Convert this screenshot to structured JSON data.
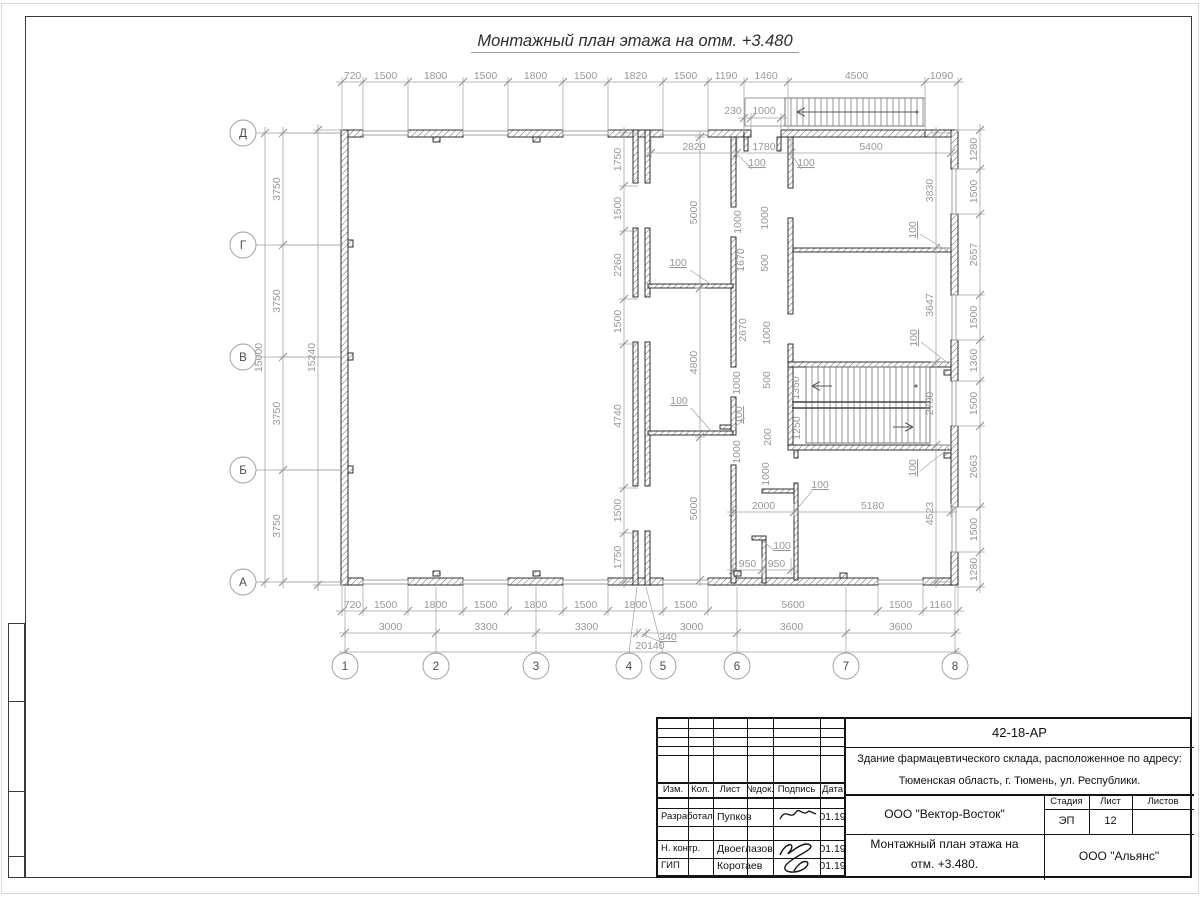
{
  "title": "Монтажный план этажа на отм. +3.480",
  "plan": {
    "colors": {
      "wall_stroke": "#1c1c1c",
      "dim": "#a3a3a3",
      "dim_text": "#989898",
      "bubble_text": "#4a4a4a",
      "stair": "#6b6b6b"
    },
    "walls": [
      [
        341,
        130,
        22,
        7
      ],
      [
        408,
        130,
        55,
        7
      ],
      [
        508,
        130,
        55,
        7
      ],
      [
        608,
        130,
        55,
        7
      ],
      [
        708,
        130,
        36,
        7
      ],
      [
        744,
        130,
        7,
        7
      ],
      [
        781,
        130,
        144,
        7
      ],
      [
        925,
        130,
        33,
        7
      ],
      [
        744,
        137,
        4,
        14
      ],
      [
        777,
        137,
        4,
        14
      ],
      [
        341,
        578,
        22,
        7
      ],
      [
        408,
        578,
        55,
        7
      ],
      [
        508,
        578,
        55,
        7
      ],
      [
        608,
        578,
        55,
        7
      ],
      [
        708,
        578,
        170,
        7
      ],
      [
        923,
        578,
        35,
        7
      ],
      [
        341,
        130,
        7,
        455
      ],
      [
        951,
        130,
        7,
        39
      ],
      [
        951,
        214,
        7,
        81
      ],
      [
        951,
        340,
        7,
        41
      ],
      [
        951,
        426,
        7,
        81
      ],
      [
        951,
        552,
        7,
        33
      ],
      [
        633,
        130,
        5,
        53
      ],
      [
        633,
        228,
        5,
        69
      ],
      [
        633,
        342,
        5,
        144
      ],
      [
        633,
        531,
        5,
        54
      ],
      [
        645,
        130,
        5,
        53
      ],
      [
        645,
        228,
        5,
        69
      ],
      [
        645,
        342,
        5,
        144
      ],
      [
        645,
        531,
        5,
        54
      ],
      [
        731,
        137,
        5,
        70
      ],
      [
        731,
        237,
        5,
        130
      ],
      [
        731,
        397,
        5,
        38
      ],
      [
        731,
        465,
        5,
        118
      ],
      [
        788,
        137,
        5,
        51
      ],
      [
        788,
        218,
        5,
        96
      ],
      [
        788,
        344,
        5,
        18
      ],
      [
        788,
        362,
        163,
        5
      ],
      [
        788,
        367,
        5,
        78
      ],
      [
        788,
        445,
        163,
        5
      ],
      [
        794,
        450,
        4,
        8
      ],
      [
        794,
        483,
        4,
        97
      ],
      [
        793,
        248,
        158,
        4
      ],
      [
        648,
        284,
        85,
        4
      ],
      [
        648,
        431,
        85,
        4
      ],
      [
        762,
        489,
        32,
        4
      ],
      [
        762,
        539,
        4,
        44
      ],
      [
        752,
        536,
        14,
        4
      ],
      [
        720,
        425,
        11,
        4
      ],
      [
        348,
        240,
        5,
        7
      ],
      [
        348,
        353,
        5,
        7
      ],
      [
        348,
        466,
        5,
        7
      ],
      [
        433,
        137,
        7,
        5
      ],
      [
        533,
        137,
        7,
        5
      ],
      [
        433,
        571,
        7,
        5
      ],
      [
        533,
        571,
        7,
        5
      ],
      [
        734,
        571,
        7,
        5
      ],
      [
        840,
        573,
        7,
        5
      ],
      [
        944,
        370,
        7,
        5
      ],
      [
        944,
        453,
        7,
        5
      ]
    ],
    "windows": [
      [
        363,
        131,
        45,
        4
      ],
      [
        463,
        131,
        45,
        4
      ],
      [
        563,
        131,
        45,
        4
      ],
      [
        663,
        131,
        45,
        4
      ],
      [
        363,
        580,
        45,
        4
      ],
      [
        463,
        580,
        45,
        4
      ],
      [
        563,
        580,
        45,
        4
      ],
      [
        663,
        580,
        45,
        4
      ],
      [
        878,
        580,
        45,
        4
      ],
      [
        952,
        169,
        4,
        45
      ],
      [
        952,
        295,
        4,
        45
      ],
      [
        952,
        381,
        4,
        45
      ],
      [
        952,
        507,
        4,
        45
      ]
    ],
    "lines": [
      [
        745,
        98,
        745,
        126
      ],
      [
        745,
        98,
        785,
        98
      ],
      [
        745,
        126,
        785,
        126
      ]
    ],
    "stairs": [
      {
        "x": 785,
        "y": 98,
        "w": 140,
        "h": 28,
        "step": 6,
        "rails": []
      },
      {
        "x": 806,
        "y": 367,
        "w": 124,
        "h": 76,
        "step": 6,
        "rails": [
          402,
          408
        ]
      }
    ],
    "arrows": [
      {
        "x1": 916,
        "y1": 112,
        "x2": 797,
        "y2": 112
      },
      {
        "x1": 832,
        "y1": 386,
        "x2": 812,
        "y2": 386
      },
      {
        "x1": 893,
        "y1": 427,
        "x2": 913,
        "y2": 427
      }
    ],
    "dots": [
      [
        916,
        386
      ],
      [
        917,
        112
      ]
    ],
    "dims": [
      {
        "d": "h",
        "c": 82,
        "e": [
          -5,
          50
        ],
        "pts": [
          342,
          363,
          408,
          463,
          508,
          563,
          608,
          663,
          708,
          744,
          788,
          925,
          958
        ],
        "labels": [
          "720",
          "1500",
          "1800",
          "1500",
          "1800",
          "1500",
          "1820",
          "1500",
          "1190",
          "1460",
          "4500",
          "1090"
        ]
      },
      {
        "d": "h",
        "c": 118,
        "e": [
          -5,
          12
        ],
        "pts": [
          744,
          751,
          781
        ],
        "labels": [
          "",
          ""
        ]
      },
      {
        "d": "h",
        "c": 153,
        "e": [
          -16,
          5
        ],
        "pts": [
          651,
          737,
          791,
          951
        ],
        "labels": [
          "2820",
          "1780",
          "5400"
        ]
      },
      {
        "d": "h",
        "c": 611,
        "e": [
          -26,
          5
        ],
        "pts": [
          342,
          363,
          408,
          463,
          508,
          563,
          608,
          663,
          708,
          878,
          923,
          958
        ],
        "labels": [
          "720",
          "1500",
          "1800",
          "1500",
          "1800",
          "1500",
          "1800",
          "1500",
          "5600",
          "1500",
          "1160"
        ]
      },
      {
        "d": "h",
        "c": 633,
        "e": [
          -5,
          5
        ],
        "pts": [
          345,
          436,
          536,
          637,
          646,
          737,
          846,
          955
        ],
        "labels": [
          "3000",
          "3300",
          "3300",
          "",
          "3000",
          "3600",
          "3600"
        ]
      },
      {
        "d": "h",
        "c": 652,
        "e": [
          -5,
          5
        ],
        "pts": [
          345,
          955
        ],
        "labels": [
          "20140"
        ]
      },
      {
        "d": "h",
        "c": 512,
        "e": [
          -8,
          5
        ],
        "pts": [
          733,
          794,
          951
        ],
        "labels": [
          "2000",
          "5180"
        ]
      },
      {
        "d": "h",
        "c": 570,
        "e": [
          -12,
          5
        ],
        "pts": [
          733,
          762,
          791
        ],
        "labels": [
          "950",
          "950"
        ]
      },
      {
        "d": "v",
        "c": 283,
        "e": [
          -5,
          60
        ],
        "pts": [
          133,
          245,
          357,
          470,
          582
        ],
        "labels": [
          "3750",
          "3750",
          "3750",
          "3750"
        ]
      },
      {
        "d": "v",
        "c": 265,
        "e": [
          -5,
          5
        ],
        "pts": [
          133,
          582
        ],
        "labels": [
          "15000"
        ]
      },
      {
        "d": "v",
        "c": 318,
        "e": [
          -5,
          25
        ],
        "pts": [
          130,
          585
        ],
        "labels": [
          "15240"
        ]
      },
      {
        "d": "v",
        "c": 624,
        "e": [
          -5,
          14
        ],
        "pts": [
          133,
          186,
          231,
          299,
          344,
          488,
          533,
          582
        ],
        "labels": [
          "1750",
          "1500",
          "2260",
          "1500",
          "4740",
          "1500",
          "1750"
        ]
      },
      {
        "d": "v",
        "c": 700,
        "e": [
          -5,
          5
        ],
        "pts": [
          137,
          288,
          437,
          580
        ],
        "labels": [
          "5000",
          "4800",
          "5000"
        ]
      },
      {
        "d": "v",
        "c": 936,
        "e": [
          -5,
          17
        ],
        "pts": [
          133,
          248,
          362,
          445,
          582
        ],
        "labels": [
          "3830",
          "3647",
          "2700",
          "4523"
        ]
      },
      {
        "d": "v",
        "c": 980,
        "e": [
          -25,
          5
        ],
        "pts": [
          130,
          169,
          214,
          295,
          340,
          381,
          426,
          507,
          552,
          587
        ],
        "labels": [
          "1280",
          "1500",
          "2657",
          "1500",
          "1360",
          "1500",
          "2663",
          "1500",
          "1280"
        ]
      }
    ],
    "free_labels": [
      {
        "t": "230",
        "x": 733,
        "y": 114
      },
      {
        "t": "1000",
        "x": 764,
        "y": 114
      },
      {
        "t": "100",
        "x": 757,
        "y": 166,
        "u": 1
      },
      {
        "t": "100",
        "x": 806,
        "y": 166,
        "u": 1
      },
      {
        "t": "100",
        "x": 678,
        "y": 266,
        "u": 1
      },
      {
        "t": "100",
        "x": 679,
        "y": 404,
        "u": 1
      },
      {
        "t": "1000",
        "x": 741,
        "y": 222,
        "r": 1
      },
      {
        "t": "1000",
        "x": 768,
        "y": 218,
        "r": 1
      },
      {
        "t": "1670",
        "x": 744,
        "y": 260,
        "r": 1
      },
      {
        "t": "500",
        "x": 768,
        "y": 263,
        "r": 1
      },
      {
        "t": "2670",
        "x": 746,
        "y": 330,
        "r": 1
      },
      {
        "t": "1000",
        "x": 770,
        "y": 333,
        "r": 1
      },
      {
        "t": "500",
        "x": 770,
        "y": 380,
        "r": 1
      },
      {
        "t": "1000",
        "x": 740,
        "y": 383,
        "r": 1
      },
      {
        "t": "100",
        "x": 742,
        "y": 415,
        "r": 1,
        "u": 1
      },
      {
        "t": "1350",
        "x": 799,
        "y": 388,
        "r": 1
      },
      {
        "t": "1250",
        "x": 800,
        "y": 428,
        "r": 1
      },
      {
        "t": "200",
        "x": 771,
        "y": 437,
        "r": 1
      },
      {
        "t": "1000",
        "x": 740,
        "y": 452,
        "r": 1
      },
      {
        "t": "1000",
        "x": 769,
        "y": 474,
        "r": 1
      },
      {
        "t": "100",
        "x": 820,
        "y": 488,
        "u": 1
      },
      {
        "t": "100",
        "x": 782,
        "y": 549,
        "u": 1
      },
      {
        "t": "100",
        "x": 916,
        "y": 230,
        "r": 1,
        "u": 1
      },
      {
        "t": "100",
        "x": 917,
        "y": 338,
        "r": 1,
        "u": 1
      },
      {
        "t": "100",
        "x": 916,
        "y": 468,
        "r": 1,
        "u": 1
      },
      {
        "t": "340",
        "x": 668,
        "y": 640,
        "u": 1
      }
    ],
    "leaders": [
      [
        752,
        169,
        738,
        155
      ],
      [
        801,
        169,
        792,
        155
      ],
      [
        690,
        270,
        712,
        285
      ],
      [
        691,
        408,
        712,
        432
      ],
      [
        812,
        491,
        796,
        510
      ],
      [
        775,
        551,
        763,
        541
      ],
      [
        745,
        418,
        734,
        428
      ],
      [
        920,
        234,
        949,
        252
      ],
      [
        921,
        342,
        949,
        364
      ],
      [
        920,
        471,
        949,
        448
      ],
      [
        663,
        643,
        642,
        634
      ]
    ],
    "axes_bottom": {
      "cy": 666,
      "r": 13,
      "wall_y": 587,
      "items": [
        {
          "n": "1",
          "x": 345,
          "lx": 345
        },
        {
          "n": "2",
          "x": 436,
          "lx": 436
        },
        {
          "n": "3",
          "x": 536,
          "lx": 536
        },
        {
          "n": "4",
          "x": 629,
          "lx": 637
        },
        {
          "n": "5",
          "x": 663,
          "lx": 646
        },
        {
          "n": "6",
          "x": 737,
          "lx": 737
        },
        {
          "n": "7",
          "x": 846,
          "lx": 846
        },
        {
          "n": "8",
          "x": 955,
          "lx": 955
        }
      ]
    },
    "axes_left": {
      "cx": 243,
      "r": 13,
      "wall_x": 341,
      "items": [
        {
          "n": "Д",
          "y": 133
        },
        {
          "n": "Г",
          "y": 245
        },
        {
          "n": "В",
          "y": 357
        },
        {
          "n": "Б",
          "y": 470
        },
        {
          "n": "А",
          "y": 582
        }
      ]
    }
  },
  "title_block": {
    "doc_number": "42-18-АР",
    "object_line1": "Здание фармацевтического склада, расположенное по адресу:",
    "object_line2": "Тюменская область, г. Тюмень, ул. Республики.",
    "columns": [
      "Изм.",
      "Кол.",
      "Лист",
      "№док.",
      "Подпись",
      "Дата"
    ],
    "rows": [
      {
        "role": "Разработал",
        "name": "Пупков",
        "date": "01.19"
      },
      {
        "role": "Н. контр.",
        "name": "Двоеглазов",
        "date": "01.19"
      },
      {
        "role": "ГИП",
        "name": "Коротаев",
        "date": "01.19"
      }
    ],
    "org": "ООО \"Вектор-Восток\"",
    "sheet_name_line1": "Монтажный план этажа на",
    "sheet_name_line2": "отм. +3.480.",
    "stage_label": "Стадия",
    "sheet_label": "Лист",
    "sheets_label": "Листов",
    "stage": "ЭП",
    "sheet_number": "12",
    "customer_org": "ООО \"Альянс\""
  }
}
